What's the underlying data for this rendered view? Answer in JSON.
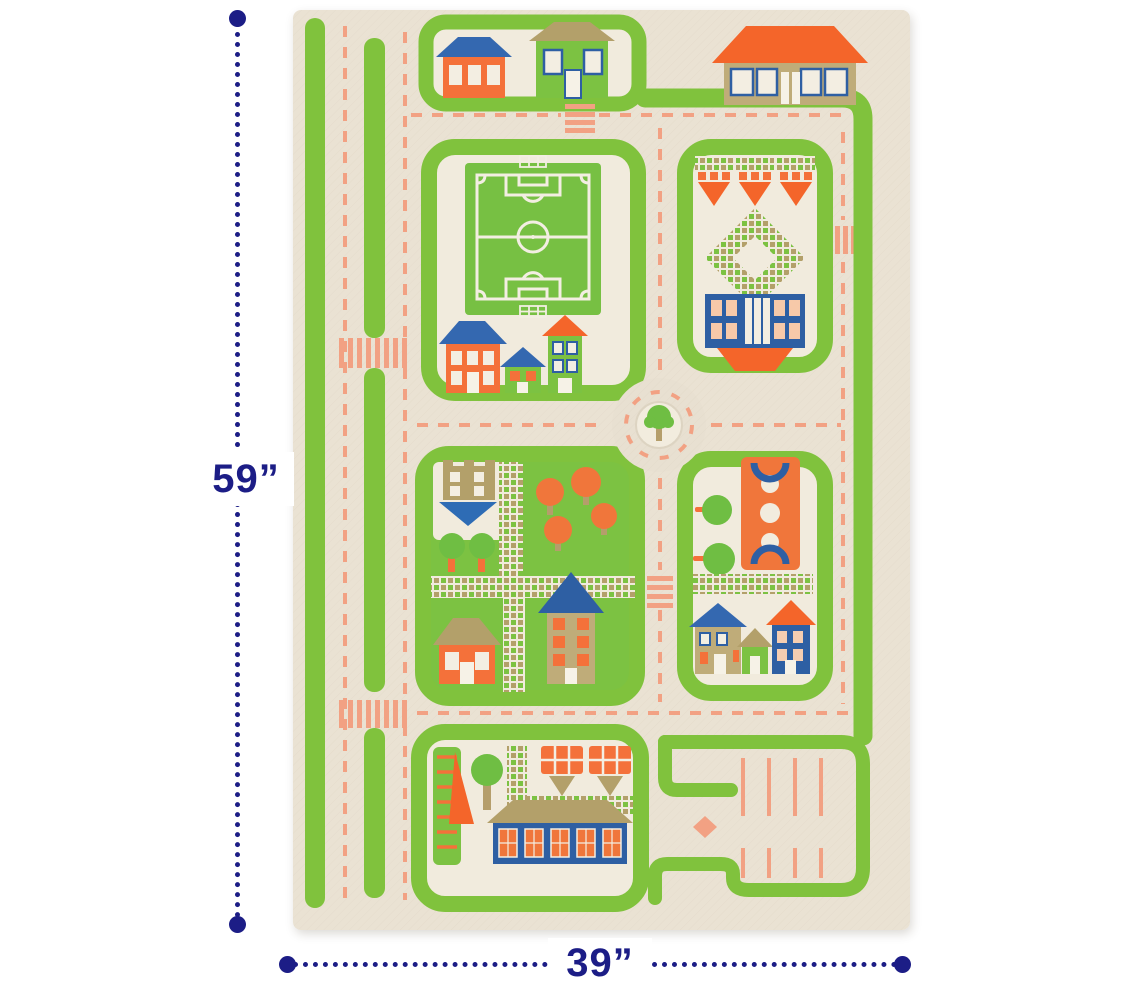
{
  "annotations": {
    "height_label": "59”",
    "width_label": "39”",
    "line_color": "#1c1d86"
  },
  "rug": {
    "palette": {
      "cream_base": "#eae2d3",
      "block_cream": "#f1ebdd",
      "hedge_green": "#80c23d",
      "park_green": "#7cc242",
      "roof_orange": "#f4652a",
      "road_salmon": "#f2a183",
      "roof_blue": "#3468b0",
      "building_blue": "#2e5fa3",
      "tan_khaki": "#b3a06a",
      "white_detail": "#f3eee2"
    },
    "features": [
      "hedge-stripes",
      "dashed-roads",
      "crosswalks",
      "houses-block",
      "soccer-field",
      "garden-parterre",
      "roundabout-with-tree",
      "park-with-trees",
      "basketball-court",
      "row-houses",
      "playground-slide",
      "school-building",
      "parking-lot-with-arrow"
    ]
  }
}
